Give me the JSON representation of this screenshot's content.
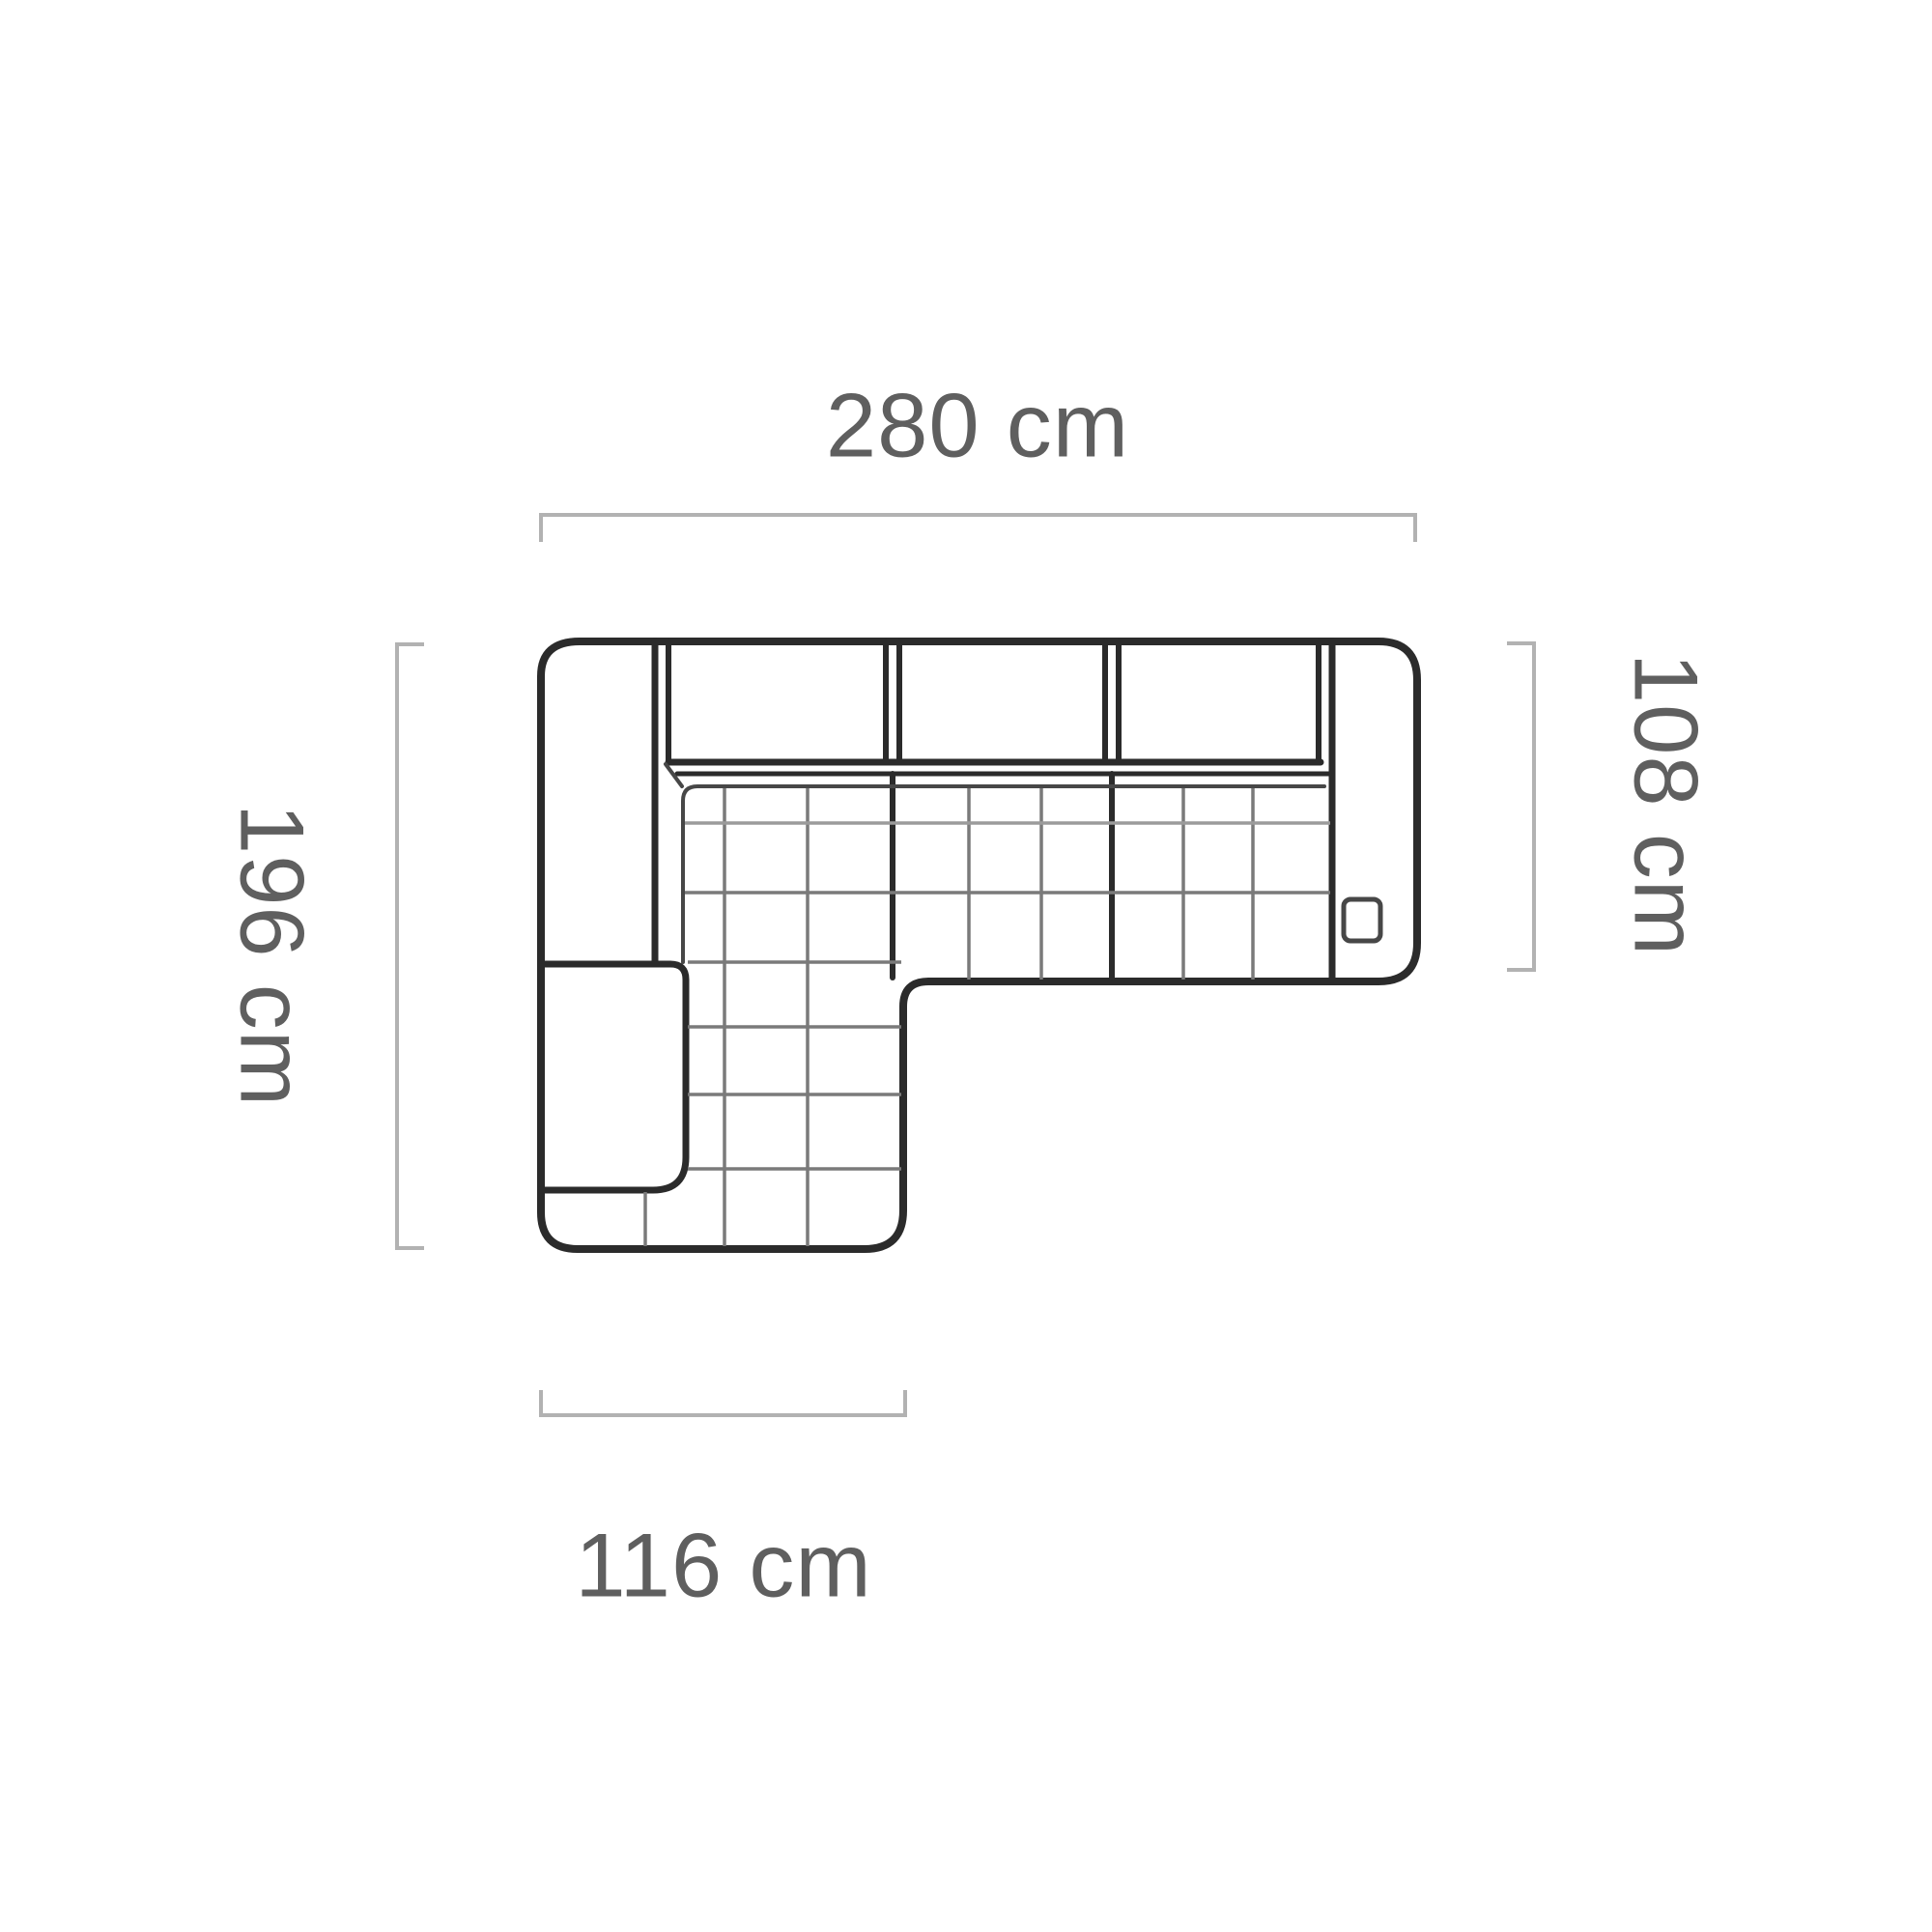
{
  "diagram": {
    "type": "corner-sofa-top-view-dimension-drawing",
    "dimensions": {
      "top": "280 cm",
      "left": "196 cm",
      "right": "108 cm",
      "bottom": "116 cm"
    },
    "parts": {
      "backrest_cushions": 3,
      "left_back_column": "corner backrest",
      "left_lower_side": "chaise side piece",
      "right_armrest": "armrest with control detail",
      "seat": "quilted L-shaped seat with chaise"
    },
    "colors": {
      "outline": "#2b2b2b",
      "seam": "#474747",
      "quilt": "#7a7a7a",
      "quilt_light": "#9b9b9b",
      "dimension_line": "#b2b2b2",
      "text": "#5f5f5f",
      "background": "#ffffff"
    }
  }
}
